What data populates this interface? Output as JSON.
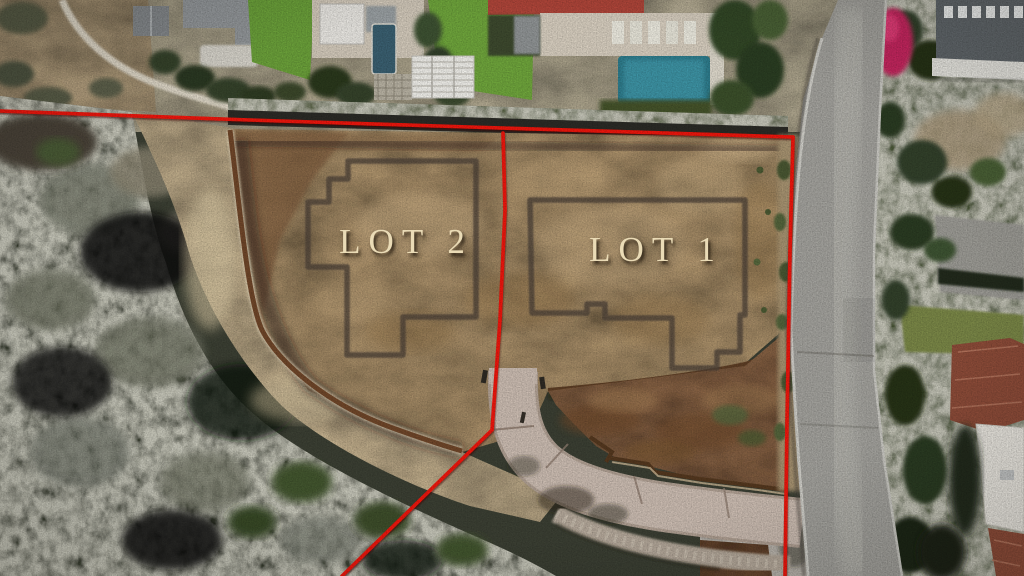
{
  "annotations": {
    "lot1_label": "LOT 1",
    "lot2_label": "LOT 2",
    "label_color": "#eadbb6"
  },
  "boundary": {
    "color": "#ee1408",
    "top_line": "0,111 250,120 470,127 793,137",
    "right_line": "793,137 790,250 787,420 785,576",
    "divider_line": "503,133 505,210 500,320 492,430 342,576"
  },
  "footprints": {
    "color": "#4e443a",
    "lot2": "348,161 476,161 476,317 403,317 403,355 347,355 347,267 308,267 308,202 329,202 329,179 348,179",
    "lot1": "530,200 745,200 745,315 740,315 740,352 717,352 717,368 672,368 672,318 605,318 605,304 587,304 587,313 532,313"
  }
}
